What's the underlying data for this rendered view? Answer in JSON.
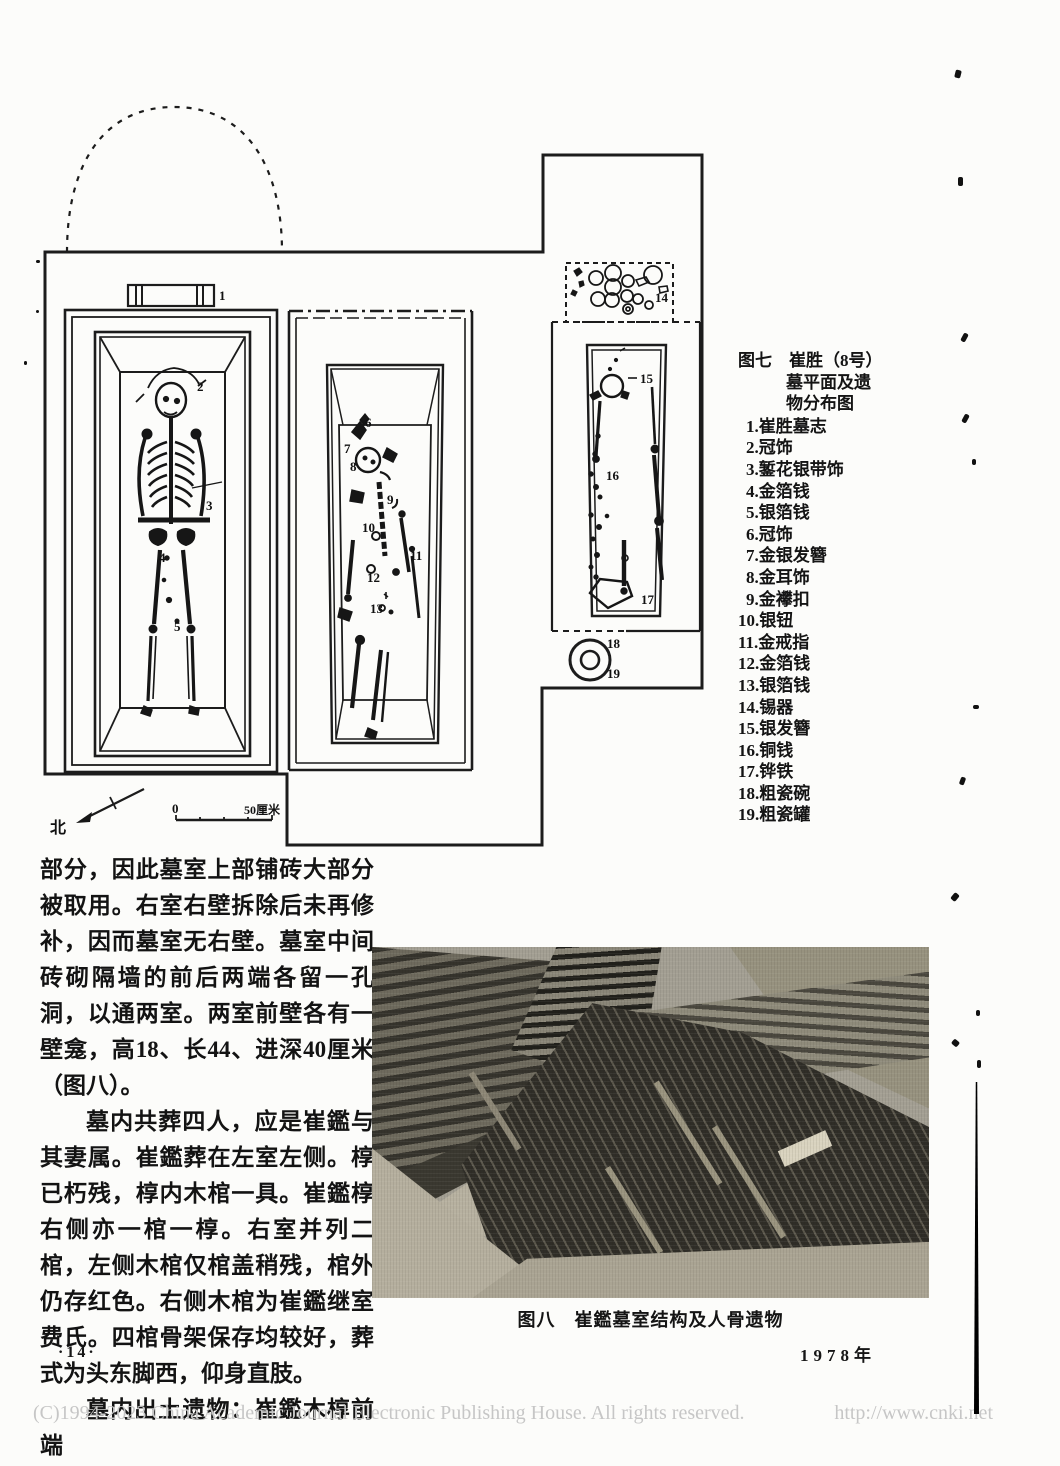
{
  "figure7": {
    "fig_no": "图七",
    "title_rest": "崔胜（8号）",
    "title_line2": "墓平面及遗",
    "title_line3": "物分布图",
    "legend": [
      "1.崔胜墓志",
      "2.冠饰",
      "3.錾花银带饰",
      "4.金箔钱",
      "5.银箔钱",
      "6.冠饰",
      "7.金银发簪",
      "8.金耳饰",
      "9.金襻扣",
      "10.银钮",
      "11.金戒指",
      "12.金箔钱",
      "13.银箔钱",
      "14.锡器",
      "15.银发簪",
      "16.铜钱",
      "17.铧铁",
      "18.粗瓷碗",
      "19.粗瓷罐"
    ],
    "compass_label": "北",
    "scale_zero": "0",
    "scale_end": "50厘米",
    "plan_labels": [
      {
        "t": "1",
        "x": 179,
        "y": 212
      },
      {
        "t": "2",
        "x": 157,
        "y": 303
      },
      {
        "t": "3",
        "x": 166,
        "y": 422
      },
      {
        "t": "4",
        "x": 119,
        "y": 474
      },
      {
        "t": "5",
        "x": 134,
        "y": 543
      },
      {
        "t": "6",
        "x": 325,
        "y": 339
      },
      {
        "t": "7",
        "x": 304,
        "y": 365
      },
      {
        "t": "8",
        "x": 310,
        "y": 383
      },
      {
        "t": "9",
        "x": 347,
        "y": 416
      },
      {
        "t": "10",
        "x": 322,
        "y": 444
      },
      {
        "t": "11",
        "x": 370,
        "y": 472
      },
      {
        "t": "12",
        "x": 327,
        "y": 494
      },
      {
        "t": "13",
        "x": 330,
        "y": 525
      },
      {
        "t": "14",
        "x": 615,
        "y": 214
      },
      {
        "t": "15",
        "x": 600,
        "y": 295
      },
      {
        "t": "16",
        "x": 566,
        "y": 392
      },
      {
        "t": "17",
        "x": 601,
        "y": 516
      },
      {
        "t": "18",
        "x": 567,
        "y": 560
      },
      {
        "t": "19",
        "x": 567,
        "y": 590
      }
    ]
  },
  "body": {
    "para1": "部分，因此墓室上部铺砖大部分被取用。右室右壁拆除后未再修补，因而墓室无右壁。墓室中间砖砌隔墙的前后两端各留一孔洞，以通两室。两室前壁各有一壁龛，高18、长44、进深40厘米（图八）。",
    "para2": "墓内共葬四人，应是崔鑑与其妻属。崔鑑葬在左室左侧。椁已朽残，椁内木棺一具。崔鑑椁右侧亦一棺一椁。右室并列二棺，左侧木棺仅棺盖稍残，棺外仍存红色。右侧木棺为崔鑑继室费氏。四棺骨架保存均较好，葬式为头东脚西，仰身直肢。",
    "para3": "墓内出土遗物：崔鑑木椁前端"
  },
  "figure8": {
    "caption": "图八　崔鑑墓室结构及人骨遗物"
  },
  "page": {
    "page_number": "·14·",
    "year": "1978年",
    "copyright": "(C)1994-2023 China Academic Journal Electronic Publishing House. All rights reserved.",
    "url": "http://www.cnki.net"
  }
}
